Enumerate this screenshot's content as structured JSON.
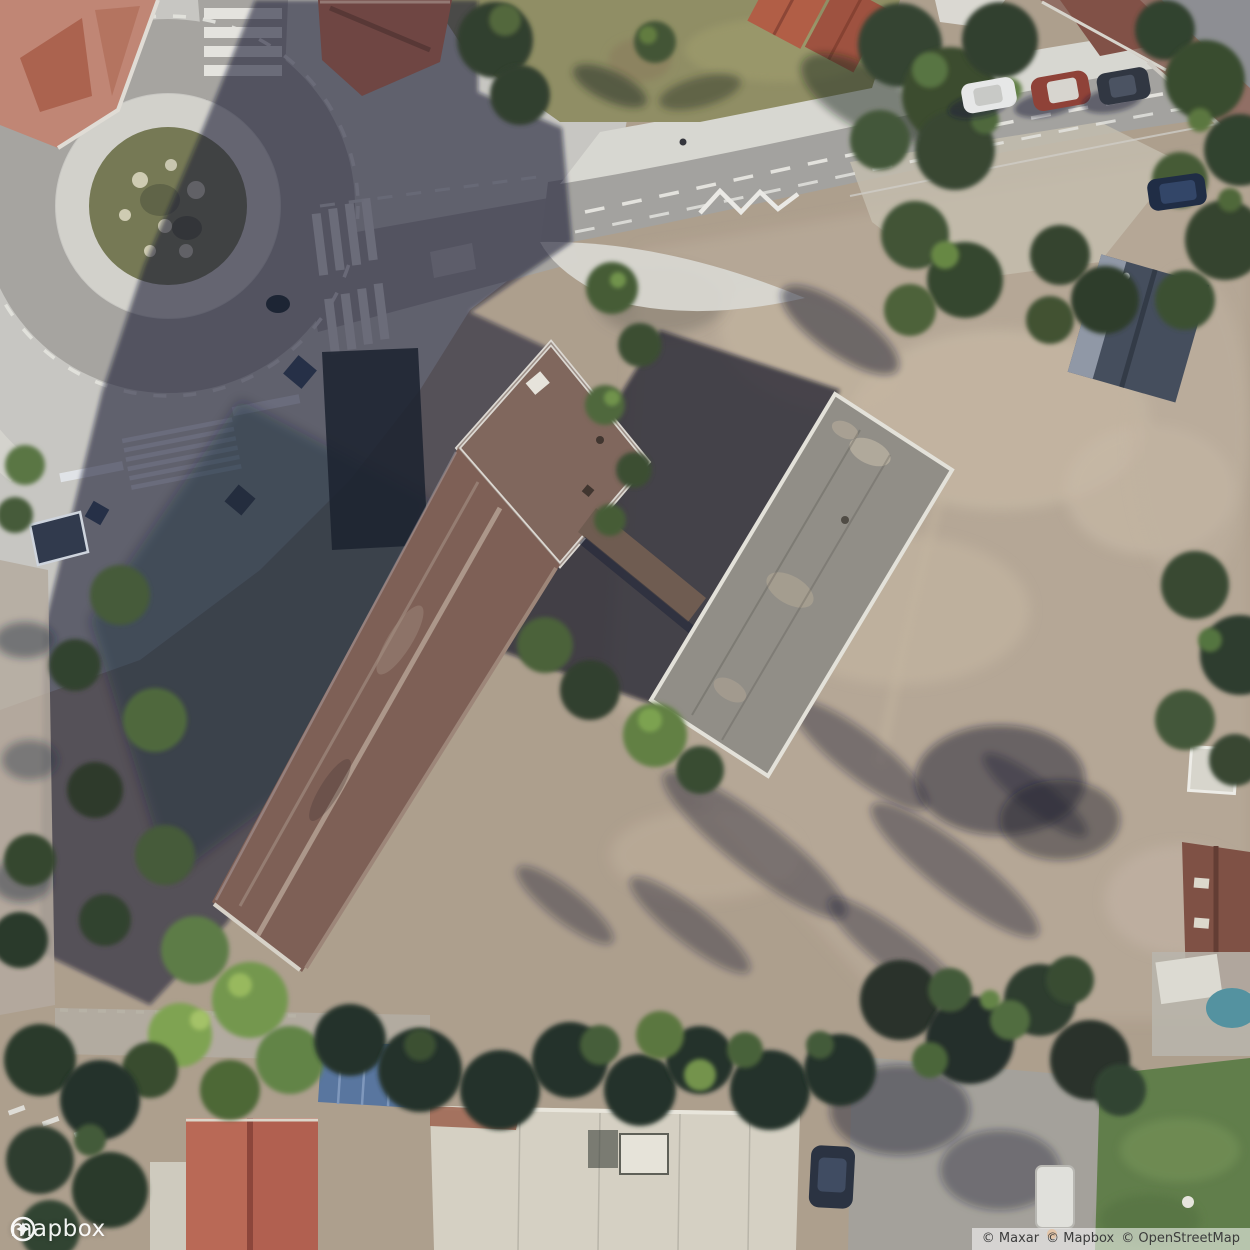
{
  "map": {
    "type": "satellite",
    "logo_text": "mapbox",
    "attribution": [
      "© Maxar",
      "© Mapbox",
      "© OpenStreetMap"
    ]
  },
  "palette": {
    "dirt": "#ac9c8a",
    "dirt_light": "#c3b3a0",
    "plaza_concrete": "#c8c6c1",
    "asphalt": "#a5a29e",
    "road_marking": "#e9e7e2",
    "shadow": "rgba(12,20,44,0.6)",
    "tree_dark": "#243122",
    "tree_mid": "#3f5530",
    "tree_bright": "#6f9447",
    "lawn": "#8e8b5f",
    "roof_long_building": "#7b5a50",
    "roof_gray_building": "#8f8b83",
    "roof_red_house": "#b05a49",
    "roof_white_building": "#d6d0c2",
    "roundabout_bushes": "#72744f",
    "pool_water": "#4e8f9e",
    "carport_blue": "#54719c"
  }
}
